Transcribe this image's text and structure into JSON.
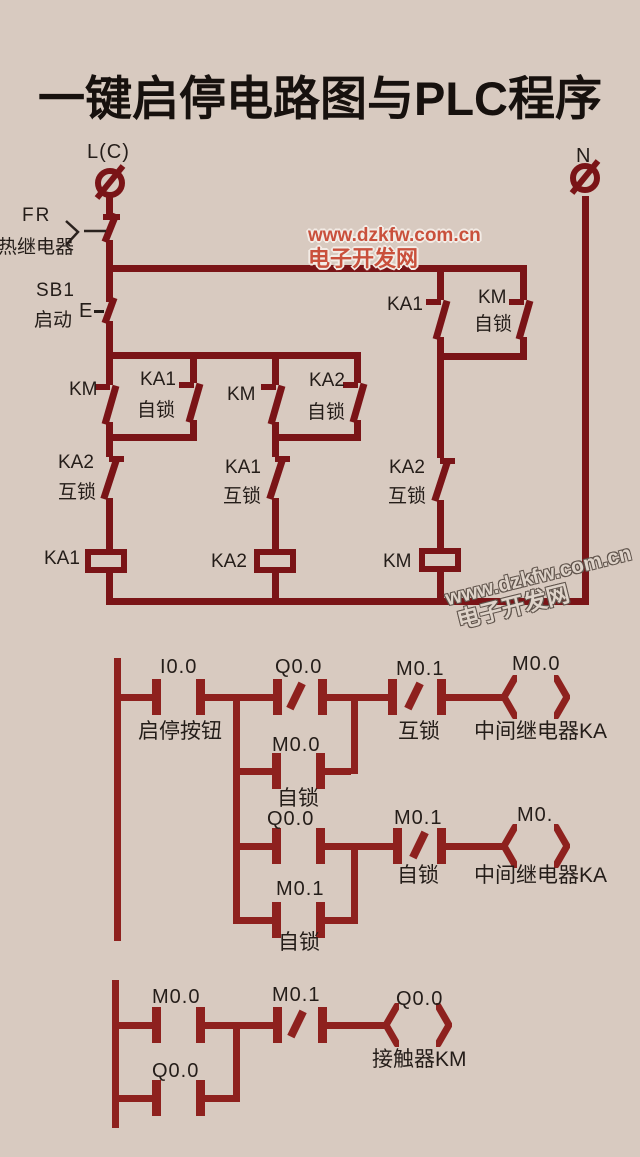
{
  "title": "一键启停电路图与PLC程序",
  "colors": {
    "background": "#d8cac0",
    "relay_line": "#7a1417",
    "ladder_line": "#8e211e",
    "title_text": "#17110e",
    "label_text": "#241d19",
    "watermark_red": "#c9503c",
    "watermark_gray": "#ded3c9"
  },
  "watermarks": {
    "red": {
      "line1": "www.dzkfw.com.cn",
      "line2": "电子开发网"
    },
    "gray": {
      "line1": "www.dzkfw.com.cn",
      "line2": "电子开发网"
    }
  },
  "relay": {
    "l_terminal": "L(C)",
    "n_terminal": "N",
    "fr": "FR",
    "fr_name": "热继电器",
    "sb1": "SB1",
    "sb1_name": "启动",
    "sb1_e": "E",
    "ka1_top": "KA1",
    "km_top": "KM",
    "km_top_note": "自锁",
    "km_p1": "KM",
    "ka1_p1": "KA1",
    "ka1_p1_note": "自锁",
    "km_p2": "KM",
    "ka2_p2": "KA2",
    "ka2_p2_note": "自锁",
    "ka2_il": "KA2",
    "ka2_il_note": "互锁",
    "ka1_il": "KA1",
    "ka1_il_note": "互锁",
    "ka2_il_r": "KA2",
    "ka2_il_r_note": "互锁",
    "coil_ka1": "KA1",
    "coil_ka2": "KA2",
    "coil_km": "KM"
  },
  "ladder": {
    "n1": {
      "i00": "I0.0",
      "i00_name": "启停按钮",
      "q00_nc": "Q0.0",
      "m01_nc": "M0.1",
      "m01_note": "互锁",
      "coil": "M0.0",
      "coil_name": "中间继电器KA",
      "br_m00": "M0.0",
      "br_m00_note": "自锁"
    },
    "n2": {
      "q00": "Q0.0",
      "m01_nc": "M0.1",
      "m01_note": "自锁",
      "coil": "M0.",
      "coil_name": "中间继电器KA",
      "br_m01": "M0.1",
      "br_m01_note": "自锁"
    },
    "n3": {
      "m00": "M0.0",
      "m01_nc": "M0.1",
      "coil": "Q0.0",
      "coil_name": "接触器KM",
      "br_q00": "Q0.0"
    }
  }
}
